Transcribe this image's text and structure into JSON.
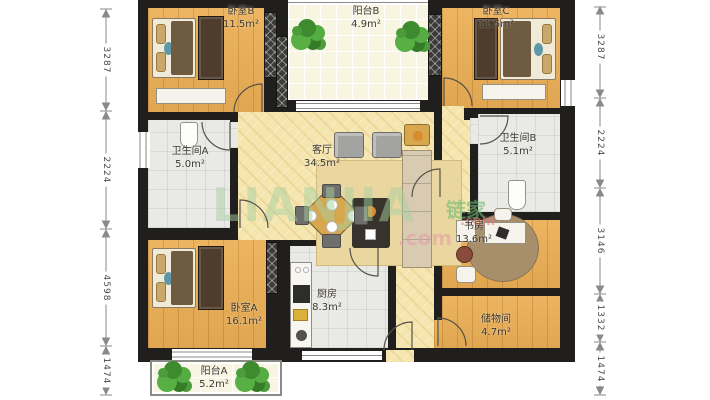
{
  "rooms": {
    "bedroom_b": {
      "name": "卧室B",
      "area": "11.5m²"
    },
    "balcony_b": {
      "name": "阳台B",
      "area": "4.9m²"
    },
    "bedroom_c": {
      "name": "卧室C",
      "area": "11.5m²"
    },
    "bathroom_a": {
      "name": "卫生间A",
      "area": "5.0m²"
    },
    "living_room": {
      "name": "客厅",
      "area": "34.5m²"
    },
    "bathroom_b": {
      "name": "卫生间B",
      "area": "5.1m²"
    },
    "study": {
      "name": "书房",
      "area": "13.6m²"
    },
    "bedroom_a": {
      "name": "卧室A",
      "area": "16.1m²"
    },
    "kitchen": {
      "name": "厨房",
      "area": "8.3m²"
    },
    "storage": {
      "name": "储物间",
      "area": "4.7m²"
    },
    "balcony_a": {
      "name": "阳台A",
      "area": "5.2m²"
    }
  },
  "dimensions_mm": {
    "left": [
      "3287",
      "2224",
      "4598",
      "1474"
    ],
    "right": [
      "3287",
      "2224",
      "3146",
      "1332",
      "1474"
    ]
  },
  "watermark": {
    "brand": "LIANJIA",
    "brand_suffix": ".com",
    "logo": "链家",
    "logo_suffix": ".com"
  },
  "colors": {
    "wall": "#201F1D",
    "wood_floor": "#ECAF55",
    "living_floor": "#F5E5AE",
    "tile_floor": "#E9E9E6",
    "balcony_floor": "#F8F5E2",
    "plant_green": "#4C9C3C",
    "watermark_green": "#A7D0A0",
    "watermark_pink": "#E49EA8"
  }
}
